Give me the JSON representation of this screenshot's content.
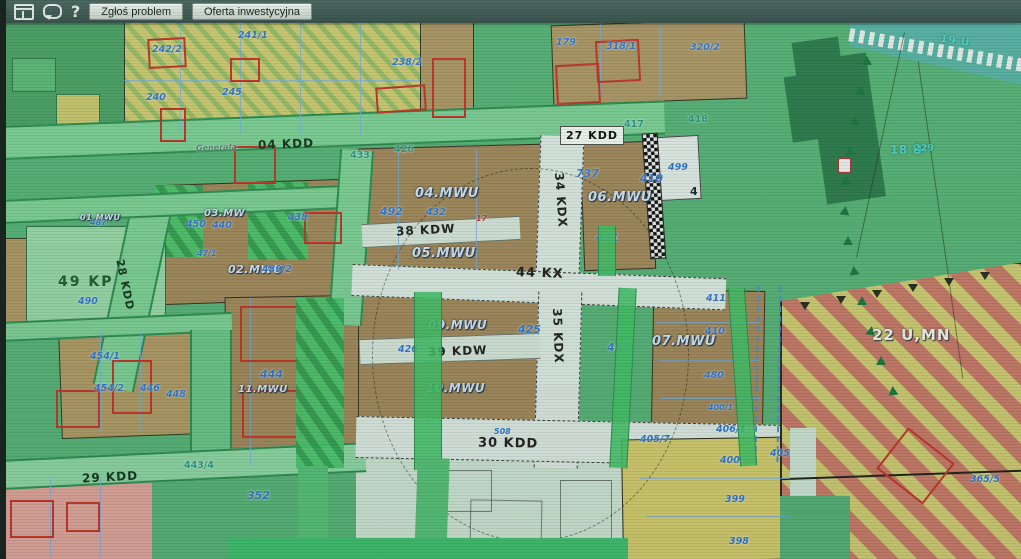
{
  "toolbar": {
    "report_button": "Zgłoś problem",
    "investment_button": "Oferta inwestycyjna",
    "help_label": "?"
  },
  "map": {
    "roads": {
      "kdd04": "04 KDD",
      "street_name": "Generała",
      "kdd27": "27 KDD",
      "kdd28": "28 KDD",
      "kdd29": "29 KDD",
      "kdd30": "30 KDD",
      "kdw38": "38 KDW",
      "kdw39": "39 KDW",
      "kdx34": "34 KDX",
      "kdx35": "35 KDX",
      "kx44": "44 KX"
    },
    "zones": {
      "mwu01": "01.MWU",
      "mwu02": "02.MWU",
      "mw03": "03.MW",
      "mwu04": "04.MWU",
      "mwu05": "05.MWU",
      "mwu06": "06.MWU",
      "mwu07": "07.MWU",
      "mwu09": "09.MWU",
      "mwu10": "10.MWU",
      "mwu11": "11.MWU",
      "kp49": "49 KP",
      "umn22": "22 U,MN",
      "u18": "18 U",
      "u19": "19 U"
    },
    "parcels": {
      "p241_1": "241/1",
      "p242_2": "242/2",
      "p240": "240",
      "p245": "245",
      "p238_2": "238/2",
      "p179": "179",
      "p318_1": "318/1",
      "p320_2": "320/2",
      "p426r": "426",
      "p433r": "433",
      "p438": "438",
      "p450": "450",
      "p440": "440",
      "p487": "487",
      "p47_1": "47/1",
      "p489_2": "489/2",
      "p490": "490",
      "p492": "492",
      "p432": "432",
      "p17": "17",
      "p737": "737",
      "p417": "417",
      "p418": "418",
      "p499": "499",
      "p410a": "410",
      "p4": "4",
      "p451": "451",
      "p425": "425",
      "p426": "426",
      "p411": "411",
      "p410b": "410",
      "p480": "480",
      "p400_1": "400/1",
      "p461": "461",
      "p444": "444",
      "p454_1": "454/1",
      "p454_2": "454/2",
      "p446": "446",
      "p448": "448",
      "p443_4": "443/4",
      "p352": "352",
      "p508": "508",
      "p405_7": "405/7",
      "p406_1": "406/1",
      "p400": "400",
      "p399": "399",
      "p398": "398",
      "p405": "405",
      "p365_5": "365/5",
      "p229": "229"
    }
  }
}
